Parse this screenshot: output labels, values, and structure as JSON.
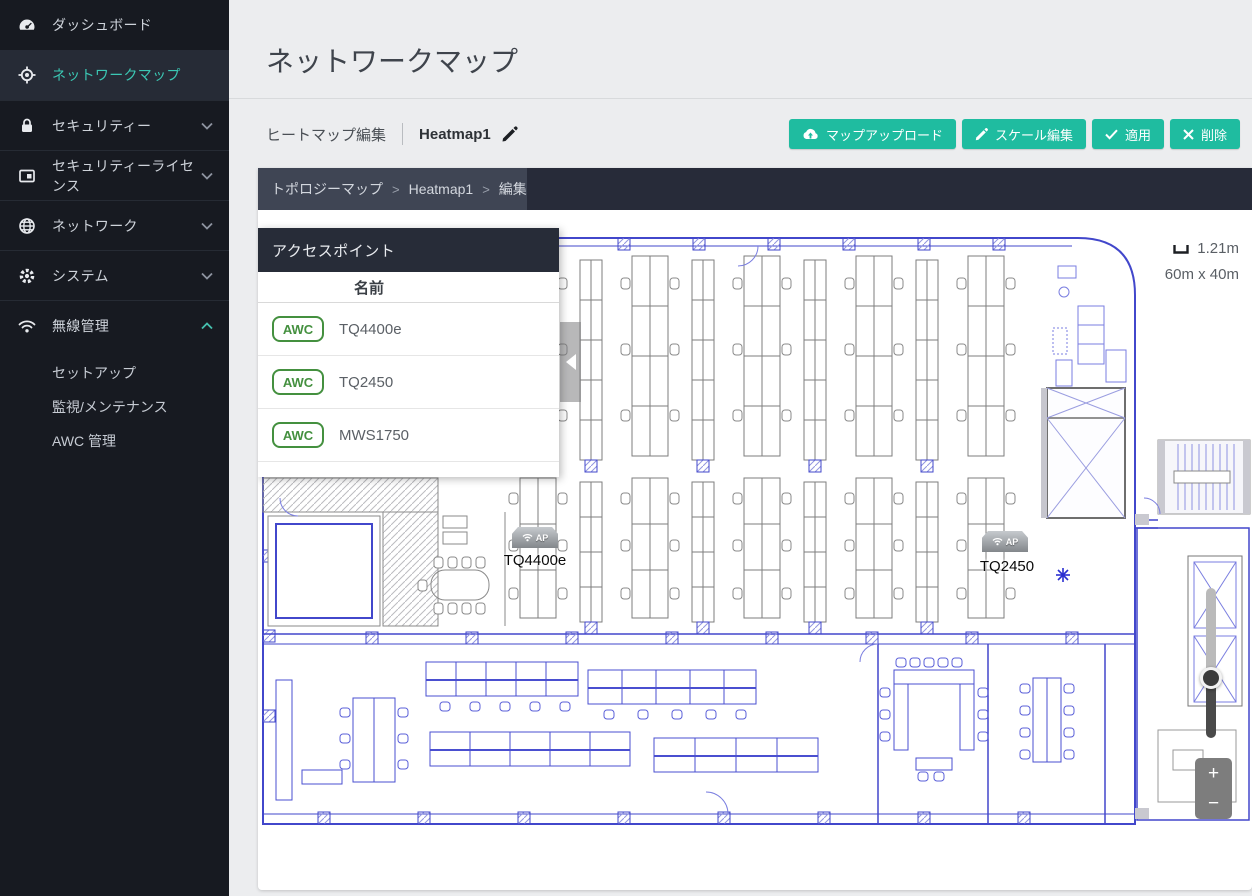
{
  "sidebar": {
    "items": [
      {
        "label": "ダッシュボード",
        "icon": "gauge-icon",
        "active": false,
        "chevron": ""
      },
      {
        "label": "ネットワークマップ",
        "icon": "network-map-icon",
        "active": true,
        "chevron": ""
      },
      {
        "label": "セキュリティー",
        "icon": "lock-icon",
        "active": false,
        "chevron": "down"
      },
      {
        "label": "セキュリティーライセンス",
        "icon": "license-icon",
        "active": false,
        "chevron": "down"
      },
      {
        "label": "ネットワーク",
        "icon": "globe-icon",
        "active": false,
        "chevron": "down"
      },
      {
        "label": "システム",
        "icon": "gear-icon",
        "active": false,
        "chevron": "down"
      },
      {
        "label": "無線管理",
        "icon": "wifi-icon",
        "active": false,
        "chevron": "up"
      }
    ],
    "subitems": [
      {
        "label": "セットアップ"
      },
      {
        "label": "監視/メンテナンス"
      },
      {
        "label": "AWC 管理"
      }
    ]
  },
  "header": {
    "title": "ネットワークマップ"
  },
  "toolbar": {
    "edit_label": "ヒートマップ編集",
    "map_name": "Heatmap1",
    "buttons": [
      {
        "label": "マップアップロード",
        "icon": "cloud-upload-icon"
      },
      {
        "label": "スケール編集",
        "icon": "pencil-icon"
      },
      {
        "label": "適用",
        "icon": "check-icon"
      },
      {
        "label": "削除",
        "icon": "x-icon"
      }
    ]
  },
  "breadcrumb": {
    "separator": ">",
    "items": [
      "トポロジーマップ",
      "Heatmap1",
      "編集"
    ]
  },
  "ap_panel": {
    "title": "アクセスポイント",
    "name_column": "名前",
    "rows": [
      {
        "badge": "AWC",
        "name": "TQ4400e"
      },
      {
        "badge": "AWC",
        "name": "TQ2450"
      },
      {
        "badge": "AWC",
        "name": "MWS1750"
      }
    ]
  },
  "map": {
    "scale_length": "1.21m",
    "dimensions": "60m x 40m",
    "markers": [
      {
        "ap_text": "AP",
        "label": "TQ4400e"
      },
      {
        "ap_text": "AP",
        "label": "TQ2450"
      }
    ],
    "zoom_in": "+",
    "zoom_out": "−"
  },
  "colors": {
    "accent_teal": "#1fbca0",
    "sidebar_bg": "#171a21",
    "sidebar_active_text": "#3bc8b4",
    "awc_badge_green": "#44903f",
    "plan_wall_blue": "#4247cb",
    "breadcrumb_bg": "#272b39"
  }
}
